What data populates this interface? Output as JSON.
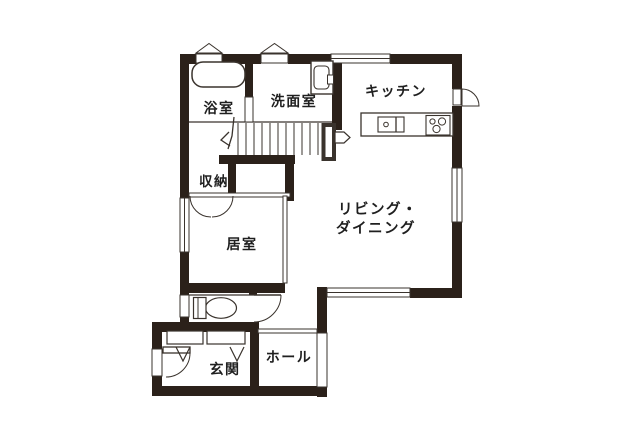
{
  "title": "1F floor plan",
  "colors": {
    "wall": "#2b211a",
    "line": "#3a332d",
    "bg": "#ffffff",
    "text": "#1f1f1f"
  },
  "rooms": {
    "bathroom": "浴室",
    "washroom": "洗面室",
    "kitchen": "キッチン",
    "storage": "収納",
    "bedroom": "居室",
    "living_line1": "リビング・",
    "living_line2": "ダイニング",
    "entrance": "玄関",
    "hall": "ホール"
  },
  "fixtures": [
    "bathtub",
    "washing-machine",
    "kitchen-counter",
    "kitchen-sink",
    "gas-stove",
    "toilet",
    "staircase",
    "stair-direction-arrow",
    "closet-double-door",
    "shoe-cabinets",
    "entrance-door",
    "kitchen-back-door",
    "toilet-door",
    "gable-vent-windows",
    "sliding-windows"
  ]
}
